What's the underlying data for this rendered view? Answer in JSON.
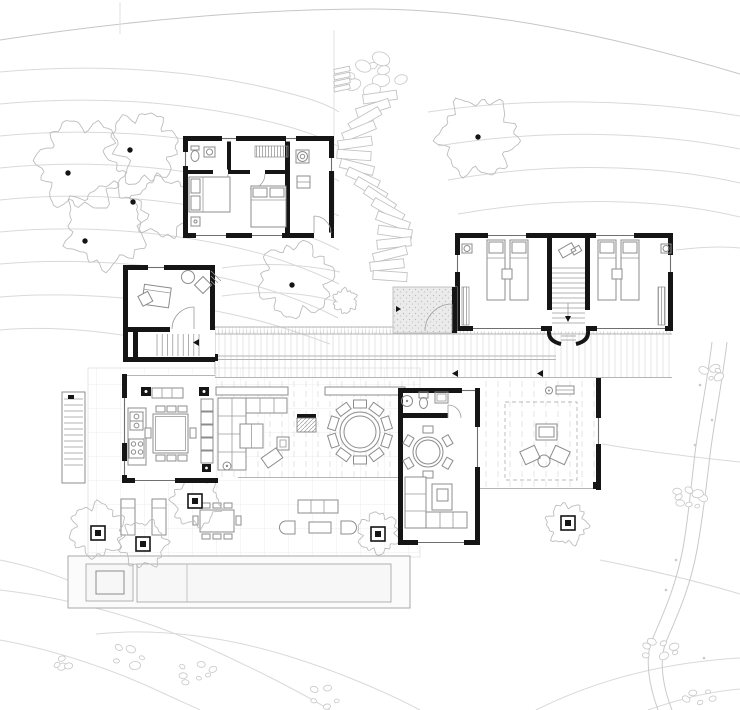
{
  "meta": {
    "title": "Architectural site and floor plan",
    "drawing_type": "floor-plan",
    "canvas": {
      "width": 740,
      "height": 710
    },
    "visible_text": "none"
  },
  "palette": {
    "background": "#ffffff",
    "wall": "#151515",
    "furniture_line": "#8c8c8c",
    "contour_line": "#d9d9d9",
    "site_line": "#c6c6c6",
    "paving_grid": "#ececec",
    "decking": "#dadada",
    "gravel_fill": "#ebebeb",
    "pool_fill": "#fbfbfb"
  },
  "buildings": {
    "guest_house": {
      "label": "guest house",
      "rooms": [
        "bedroom 1",
        "bedroom 2",
        "bathroom",
        "utility room"
      ]
    },
    "bedroom_wing": {
      "label": "bedroom wing",
      "rooms": [
        "bedroom left (twin beds)",
        "central stair hall",
        "bedroom right (twin beds)"
      ]
    },
    "main_house": {
      "label": "main house",
      "rooms": [
        "study",
        "kitchen-dining",
        "covered deck with fireplace",
        "round dining terrace",
        "family room",
        "bathroom",
        "gravel entry vestibule",
        "east lounge deck"
      ]
    },
    "outdoor": {
      "label": "outdoor",
      "features": [
        "deck walkway",
        "lower paved terrace",
        "outdoor dining set",
        "sun loungers",
        "lounge sofa set",
        "lap pool",
        "spa tub",
        "exterior stair",
        "stepped garden path",
        "stream with rocks"
      ]
    }
  },
  "site": {
    "boundary": "M0,40 C130,20 260,9 370,9 C490,9 620,38 740,74",
    "property_lines": [
      "M334,30 L334,224",
      "M120,2 L120,34"
    ],
    "contours": [
      "M0,72 C110,62 210,72 292,94 C315,100 330,106 339,112",
      "M0,104 C105,94 205,104 286,126 C311,133 328,140 339,147",
      "M0,136 C100,126 200,136 280,158 C306,166 326,174 339,181",
      "M0,168 C95,158 195,168 274,190 C301,199 323,208 339,216",
      "M0,200 C90,190 188,200 268,222 C296,231 320,240 339,250",
      "M0,232 C85,224 182,232 262,254 C291,263 317,273 339,284",
      "M0,264 C80,257 175,264 256,286 C284,294 313,305 338,318",
      "M0,297 C72,291 165,298 248,318 C270,323 300,333 330,344",
      "M0,330 C55,325 110,332 165,342",
      "M428,112 C530,97 640,99 740,116",
      "M438,146 C540,129 650,131 740,149",
      "M448,180 C550,162 655,164 740,183",
      "M458,214 C560,196 662,198 740,217",
      "M676,250 C700,247 722,246 740,248",
      "M602,444 C650,452 700,458 740,462",
      "M600,560 C650,570 700,582 740,594",
      "M222,268 C262,262 304,264 340,272",
      "M222,296 C262,290 304,292 338,302",
      "M0,590 C70,598 140,618 195,642 C250,666 300,692 330,710",
      "M0,640 C55,650 115,670 165,694 C180,701 192,706 200,710",
      "M96,634 C160,627 230,638 288,656 C340,672 390,694 420,710",
      "M536,710 C600,678 670,662 740,658",
      "M648,710 C685,697 715,691 740,689",
      "M0,560 C30,566 60,576 86,588"
    ],
    "stream": [
      "M712,342 C706,392 697,430 694,462 C690,496 688,520 683,548 C676,586 664,612 652,640 C644,660 650,688 658,710",
      "M727,342 C721,392 712,432 709,464 C705,498 702,522 697,550 C690,588 678,614 666,642 C658,662 664,690 672,710"
    ],
    "rock_clusters": [
      [
        714,
        372,
        5,
        10
      ],
      [
        688,
        498,
        8,
        14
      ],
      [
        660,
        650,
        7,
        14
      ],
      [
        700,
        698,
        5,
        12
      ],
      [
        196,
        672,
        7,
        20
      ],
      [
        128,
        656,
        5,
        13
      ],
      [
        322,
        698,
        5,
        14
      ],
      [
        64,
        664,
        4,
        10
      ]
    ],
    "rock_dots": [
      [
        700,
        385
      ],
      [
        712,
        420
      ],
      [
        695,
        445
      ],
      [
        676,
        560
      ],
      [
        666,
        590
      ],
      [
        704,
        658
      ]
    ],
    "boulders": [
      374,
      76,
      9,
      24
    ],
    "mini_steps": [
      [
        342,
        70
      ],
      [
        342,
        76
      ],
      [
        342,
        82
      ],
      [
        342,
        88
      ]
    ],
    "steps": [
      [
        380,
        97,
        -8
      ],
      [
        373,
        108,
        -18
      ],
      [
        365,
        119,
        -30
      ],
      [
        359,
        131,
        -22
      ],
      [
        355,
        143,
        -8
      ],
      [
        354,
        155,
        4
      ],
      [
        357,
        167,
        14
      ],
      [
        363,
        178,
        24
      ],
      [
        371,
        189,
        30
      ],
      [
        380,
        199,
        34
      ],
      [
        388,
        210,
        30
      ],
      [
        393,
        221,
        20
      ],
      [
        395,
        232,
        8
      ],
      [
        394,
        243,
        -6
      ],
      [
        390,
        254,
        -14
      ],
      [
        387,
        265,
        -6
      ],
      [
        390,
        276,
        4
      ]
    ],
    "step_size": [
      34,
      9
    ],
    "trees": [
      [
        82,
        165,
        48
      ],
      [
        142,
        148,
        38
      ],
      [
        106,
        226,
        44
      ],
      [
        163,
        207,
        32
      ],
      [
        478,
        137,
        42
      ],
      [
        296,
        280,
        40
      ],
      [
        345,
        301,
        13
      ],
      [
        196,
        502,
        26
      ],
      [
        143,
        544,
        25
      ],
      [
        97,
        530,
        29
      ],
      [
        378,
        533,
        22
      ],
      [
        567,
        524,
        22
      ]
    ],
    "trunks": [
      [
        130,
        150
      ],
      [
        68,
        173
      ],
      [
        133,
        202
      ],
      [
        85,
        241
      ],
      [
        478,
        137
      ],
      [
        292,
        285
      ]
    ],
    "planters": [
      [
        188,
        494
      ],
      [
        136,
        537
      ],
      [
        91,
        526
      ],
      [
        371,
        527
      ],
      [
        561,
        516
      ]
    ],
    "chair_rings": [
      {
        "cx": 360,
        "cy": 432,
        "dist": 28,
        "n": 10,
        "w": 13,
        "h": 8,
        "target": "g-deck-chairs"
      },
      {
        "cx": 428,
        "cy": 452,
        "dist": 22.5,
        "n": 6,
        "w": 10,
        "h": 7,
        "target": "g-fam-chairs"
      }
    ],
    "tread_runs": [
      {
        "target": "g-wing-stairs",
        "dir": "h",
        "x1": 552,
        "x2": 585,
        "y1": 268,
        "y2": 323,
        "n": 12
      },
      {
        "target": "g-study-stairs",
        "dir": "v",
        "x1": 157,
        "x2": 199,
        "y1": 334,
        "y2": 356,
        "n": 9
      },
      {
        "target": "g-ext-stairs",
        "dir": "h",
        "x1": 64,
        "x2": 83,
        "y1": 399,
        "y2": 465,
        "n": 12
      }
    ]
  }
}
